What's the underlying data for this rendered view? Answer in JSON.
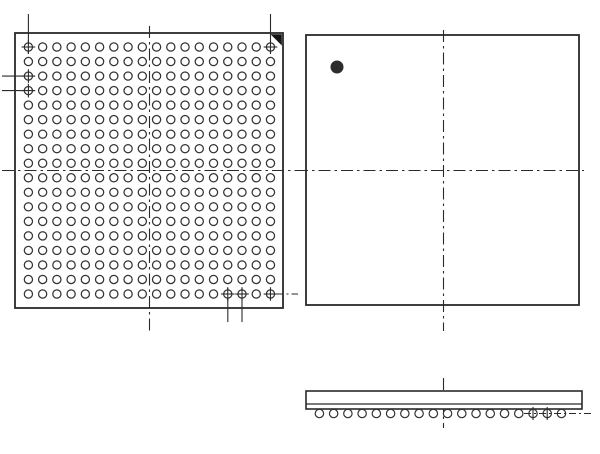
{
  "diagram": {
    "title": "BGA package outline drawing (bottom view, top view, side view)",
    "canvas": {
      "width": 600,
      "height": 454,
      "background": "#ffffff"
    },
    "colors": {
      "line": "#2a2a2a",
      "ball_stroke": "#333333",
      "ball_fill": "#ffffff",
      "a1_marker": "#141414",
      "pin1_dot": "#2d2d2d"
    },
    "bottom_view": {
      "name": "bga-ball-grid-bottom-view",
      "outline": {
        "x": 15,
        "y": 33,
        "w": 268,
        "h": 275,
        "stroke_w": 1.8
      },
      "a1_corner_triangle": {
        "points": "270.5,34.2 281.8,34.2 281.8,45.5"
      },
      "grid": {
        "cols": 18,
        "rows": 18,
        "x0": 28.4,
        "y0": 47.0,
        "pitch_x": 14.24,
        "pitch_y": 14.53,
        "ball_r": 4.1,
        "ball_stroke_w": 1.25,
        "total_balls": 324
      },
      "crosshair_balls": [
        {
          "row": 1,
          "col": 1
        },
        {
          "row": 1,
          "col": 18
        },
        {
          "row": 3,
          "col": 1
        },
        {
          "row": 4,
          "col": 1
        },
        {
          "row": 18,
          "col": 15
        },
        {
          "row": 18,
          "col": 16
        },
        {
          "row": 18,
          "col": 18
        }
      ],
      "crosshair_arm": 6.8,
      "extension_lines": [
        {
          "x1": 28.4,
          "y1": 14,
          "x2": 28.4,
          "y2": 54,
          "dashed": false
        },
        {
          "x1": 270.5,
          "y1": 14,
          "x2": 270.5,
          "y2": 54,
          "dashed": false
        },
        {
          "x1": 2,
          "y1": 76.1,
          "x2": 35,
          "y2": 76.1,
          "dashed": false
        },
        {
          "x1": 2,
          "y1": 90.6,
          "x2": 35,
          "y2": 90.6,
          "dashed": false
        },
        {
          "x1": 227.8,
          "y1": 288,
          "x2": 227.8,
          "y2": 322,
          "dashed": false
        },
        {
          "x1": 242.0,
          "y1": 288,
          "x2": 242.0,
          "y2": 322,
          "dashed": false
        },
        {
          "x1": 276.5,
          "y1": 294,
          "x2": 298,
          "y2": 294,
          "dashed": true
        }
      ],
      "centerlines": [
        {
          "x1": 149.5,
          "y1": 26,
          "x2": 149.5,
          "y2": 331
        },
        {
          "x1": 2,
          "y1": 170.5,
          "x2": 296,
          "y2": 170.5
        }
      ]
    },
    "top_view": {
      "name": "package-top-view",
      "outline": {
        "x": 306,
        "y": 35,
        "w": 273,
        "h": 270,
        "stroke_w": 1.8
      },
      "pin1_dot": {
        "cx": 337,
        "cy": 67,
        "r": 6.5
      },
      "centerlines": [
        {
          "x1": 443.5,
          "y1": 30,
          "x2": 443.5,
          "y2": 331
        },
        {
          "x1": 296,
          "y1": 170.5,
          "x2": 584,
          "y2": 170.5
        }
      ]
    },
    "side_view": {
      "name": "package-side-view",
      "body": {
        "x": 306,
        "y": 391,
        "w": 276,
        "h": 18,
        "stroke_w": 1.6
      },
      "seam_line": {
        "x1": 306,
        "y1": 404,
        "x2": 582,
        "y2": 404
      },
      "balls": {
        "count": 18,
        "cx0": 319.4,
        "pitch": 14.24,
        "cy": 413.5,
        "r": 4.2,
        "stroke_w": 1.2
      },
      "centerline": {
        "x1": 443.5,
        "y1": 378,
        "x2": 443.5,
        "y2": 428
      },
      "ball_axis_line": {
        "x1": 524,
        "y1": 413.5,
        "x2": 594,
        "y2": 413.5
      },
      "ticks": [
        {
          "x1": 533.0,
          "y1": 407,
          "x2": 533.0,
          "y2": 420
        },
        {
          "x1": 547.2,
          "y1": 407,
          "x2": 547.2,
          "y2": 420
        }
      ]
    },
    "dash_patterns": {
      "centerline": "12 4 2.5 4",
      "extension": "7 3 2 3"
    }
  }
}
